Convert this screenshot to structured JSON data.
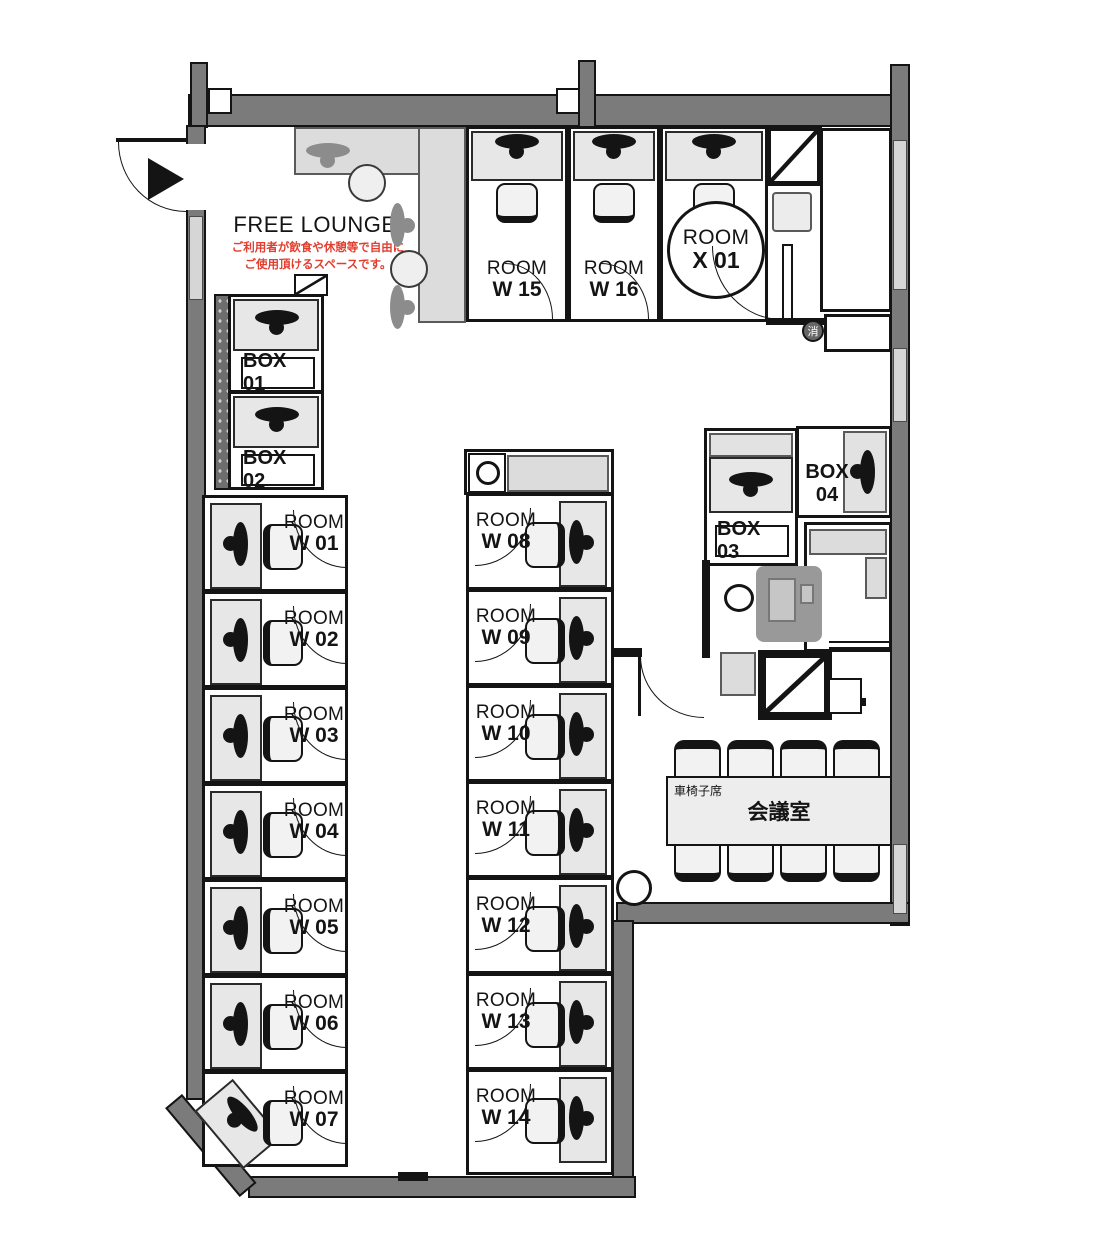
{
  "lounge": {
    "title": "FREE LOUNGE",
    "note1": "ご利用者が飲食や休憩等で自由に",
    "note2": "ご使用頂けるスペースです。"
  },
  "rooms": {
    "w01": {
      "l1": "ROOM",
      "l2": "W 01"
    },
    "w02": {
      "l1": "ROOM",
      "l2": "W 02"
    },
    "w03": {
      "l1": "ROOM",
      "l2": "W 03"
    },
    "w04": {
      "l1": "ROOM",
      "l2": "W 04"
    },
    "w05": {
      "l1": "ROOM",
      "l2": "W 05"
    },
    "w06": {
      "l1": "ROOM",
      "l2": "W 06"
    },
    "w07": {
      "l1": "ROOM",
      "l2": "W 07"
    },
    "w08": {
      "l1": "ROOM",
      "l2": "W 08"
    },
    "w09": {
      "l1": "ROOM",
      "l2": "W 09"
    },
    "w10": {
      "l1": "ROOM",
      "l2": "W 10"
    },
    "w11": {
      "l1": "ROOM",
      "l2": "W 11"
    },
    "w12": {
      "l1": "ROOM",
      "l2": "W 12"
    },
    "w13": {
      "l1": "ROOM",
      "l2": "W 13"
    },
    "w14": {
      "l1": "ROOM",
      "l2": "W 14"
    },
    "w15": {
      "l1": "ROOM",
      "l2": "W 15"
    },
    "w16": {
      "l1": "ROOM",
      "l2": "W 16"
    },
    "x01": {
      "l1": "ROOM",
      "l2": "X 01"
    }
  },
  "boxes": {
    "b01": "BOX 01",
    "b02": "BOX 02",
    "b03": "BOX 03",
    "b04": "BOX 04"
  },
  "meeting": {
    "name": "会議室",
    "wheelchair": "車椅子席"
  },
  "markers": {
    "fire": "消"
  }
}
